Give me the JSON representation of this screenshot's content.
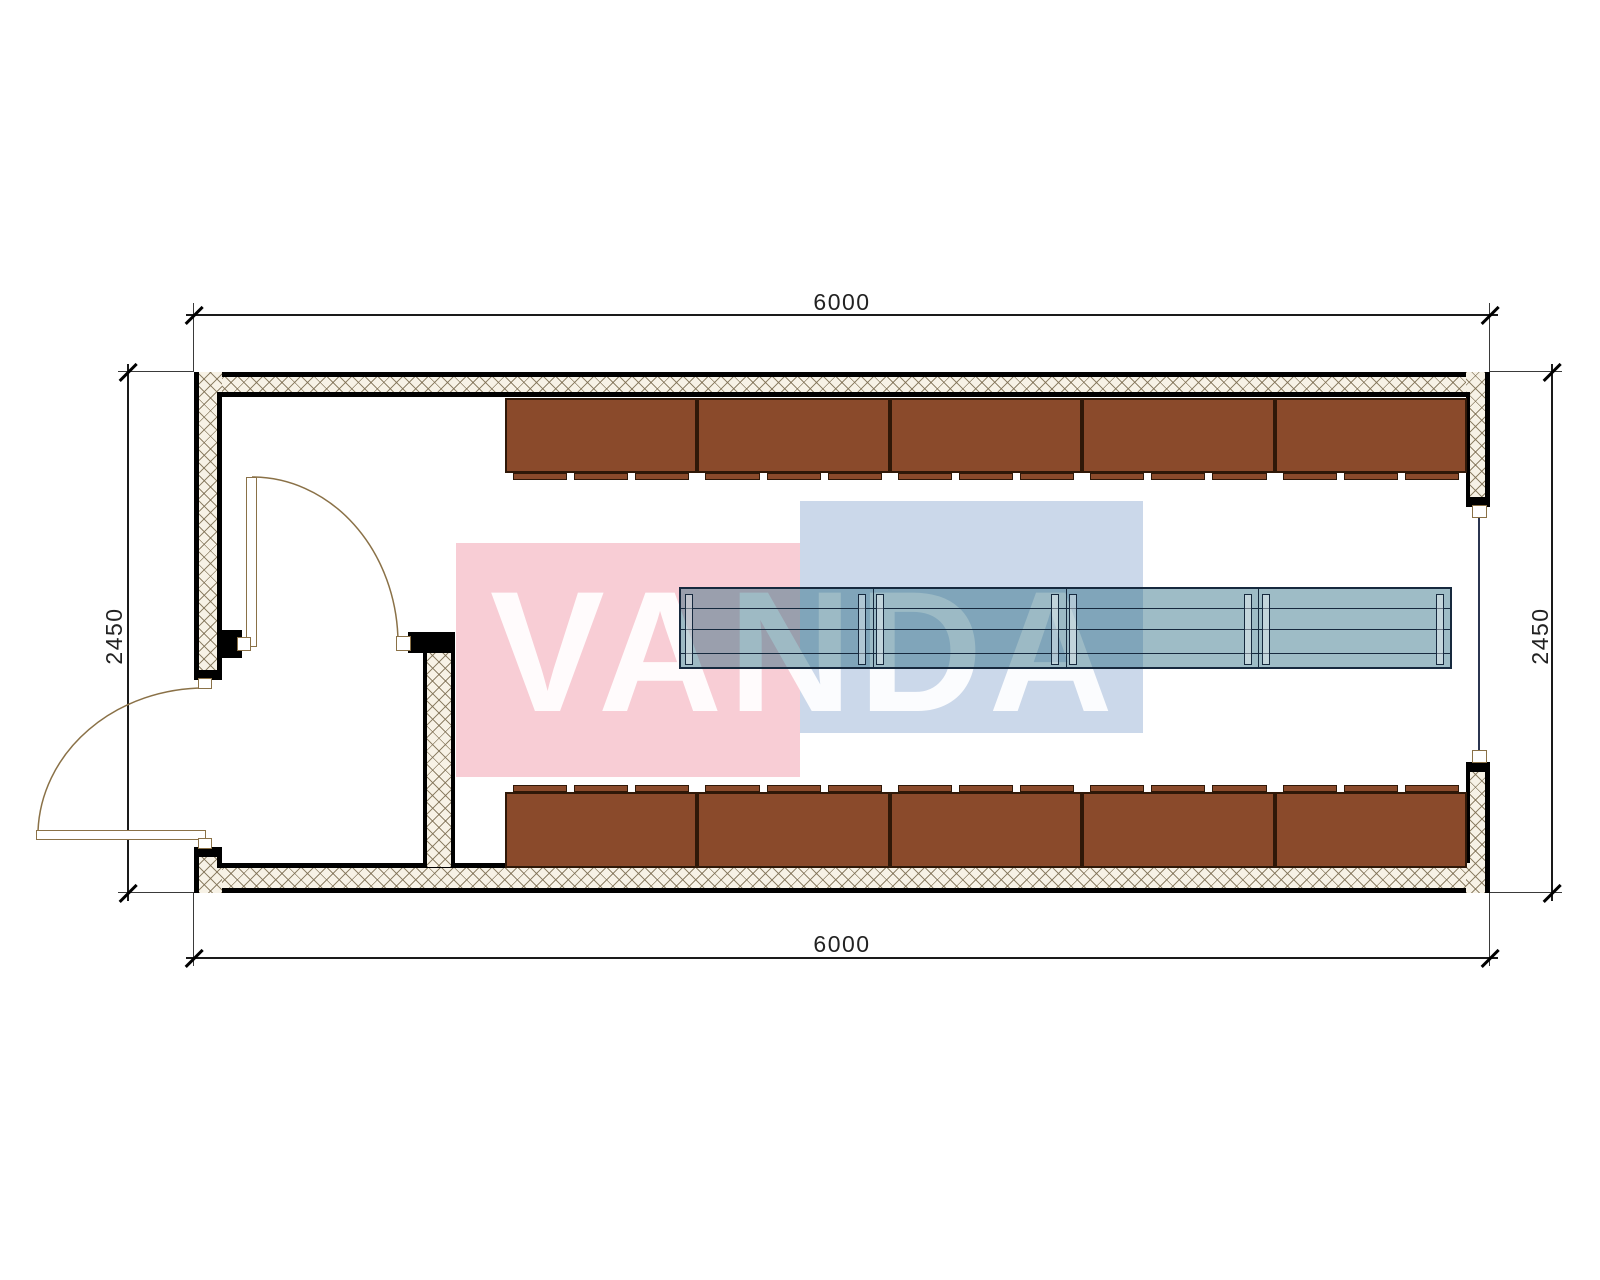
{
  "drawing": {
    "type": "container-floor-plan",
    "dimensions": {
      "top": "6000",
      "bottom": "6000",
      "left": "2450",
      "right": "2450"
    },
    "watermark": {
      "text": "VANDA",
      "pink": "#f8cdd5",
      "blue": "#cbd8ea"
    },
    "colors": {
      "cabinet": "#8a4a2b",
      "cabinet_border": "#2f1808",
      "table_fill": "rgba(25,95,118,0.42)",
      "table_border": "#16293e",
      "door_line": "#8a7147",
      "hatch_bg": "#f7f2e6"
    },
    "furniture": {
      "top_cabinet_count": 5,
      "bottom_cabinet_count": 5,
      "table_module_count": 4,
      "table_leg_offsets": [
        4,
        177,
        195,
        370,
        388,
        563,
        581,
        755
      ]
    },
    "openings": {
      "exterior_doors": 2,
      "window_right_wall": 1
    }
  }
}
